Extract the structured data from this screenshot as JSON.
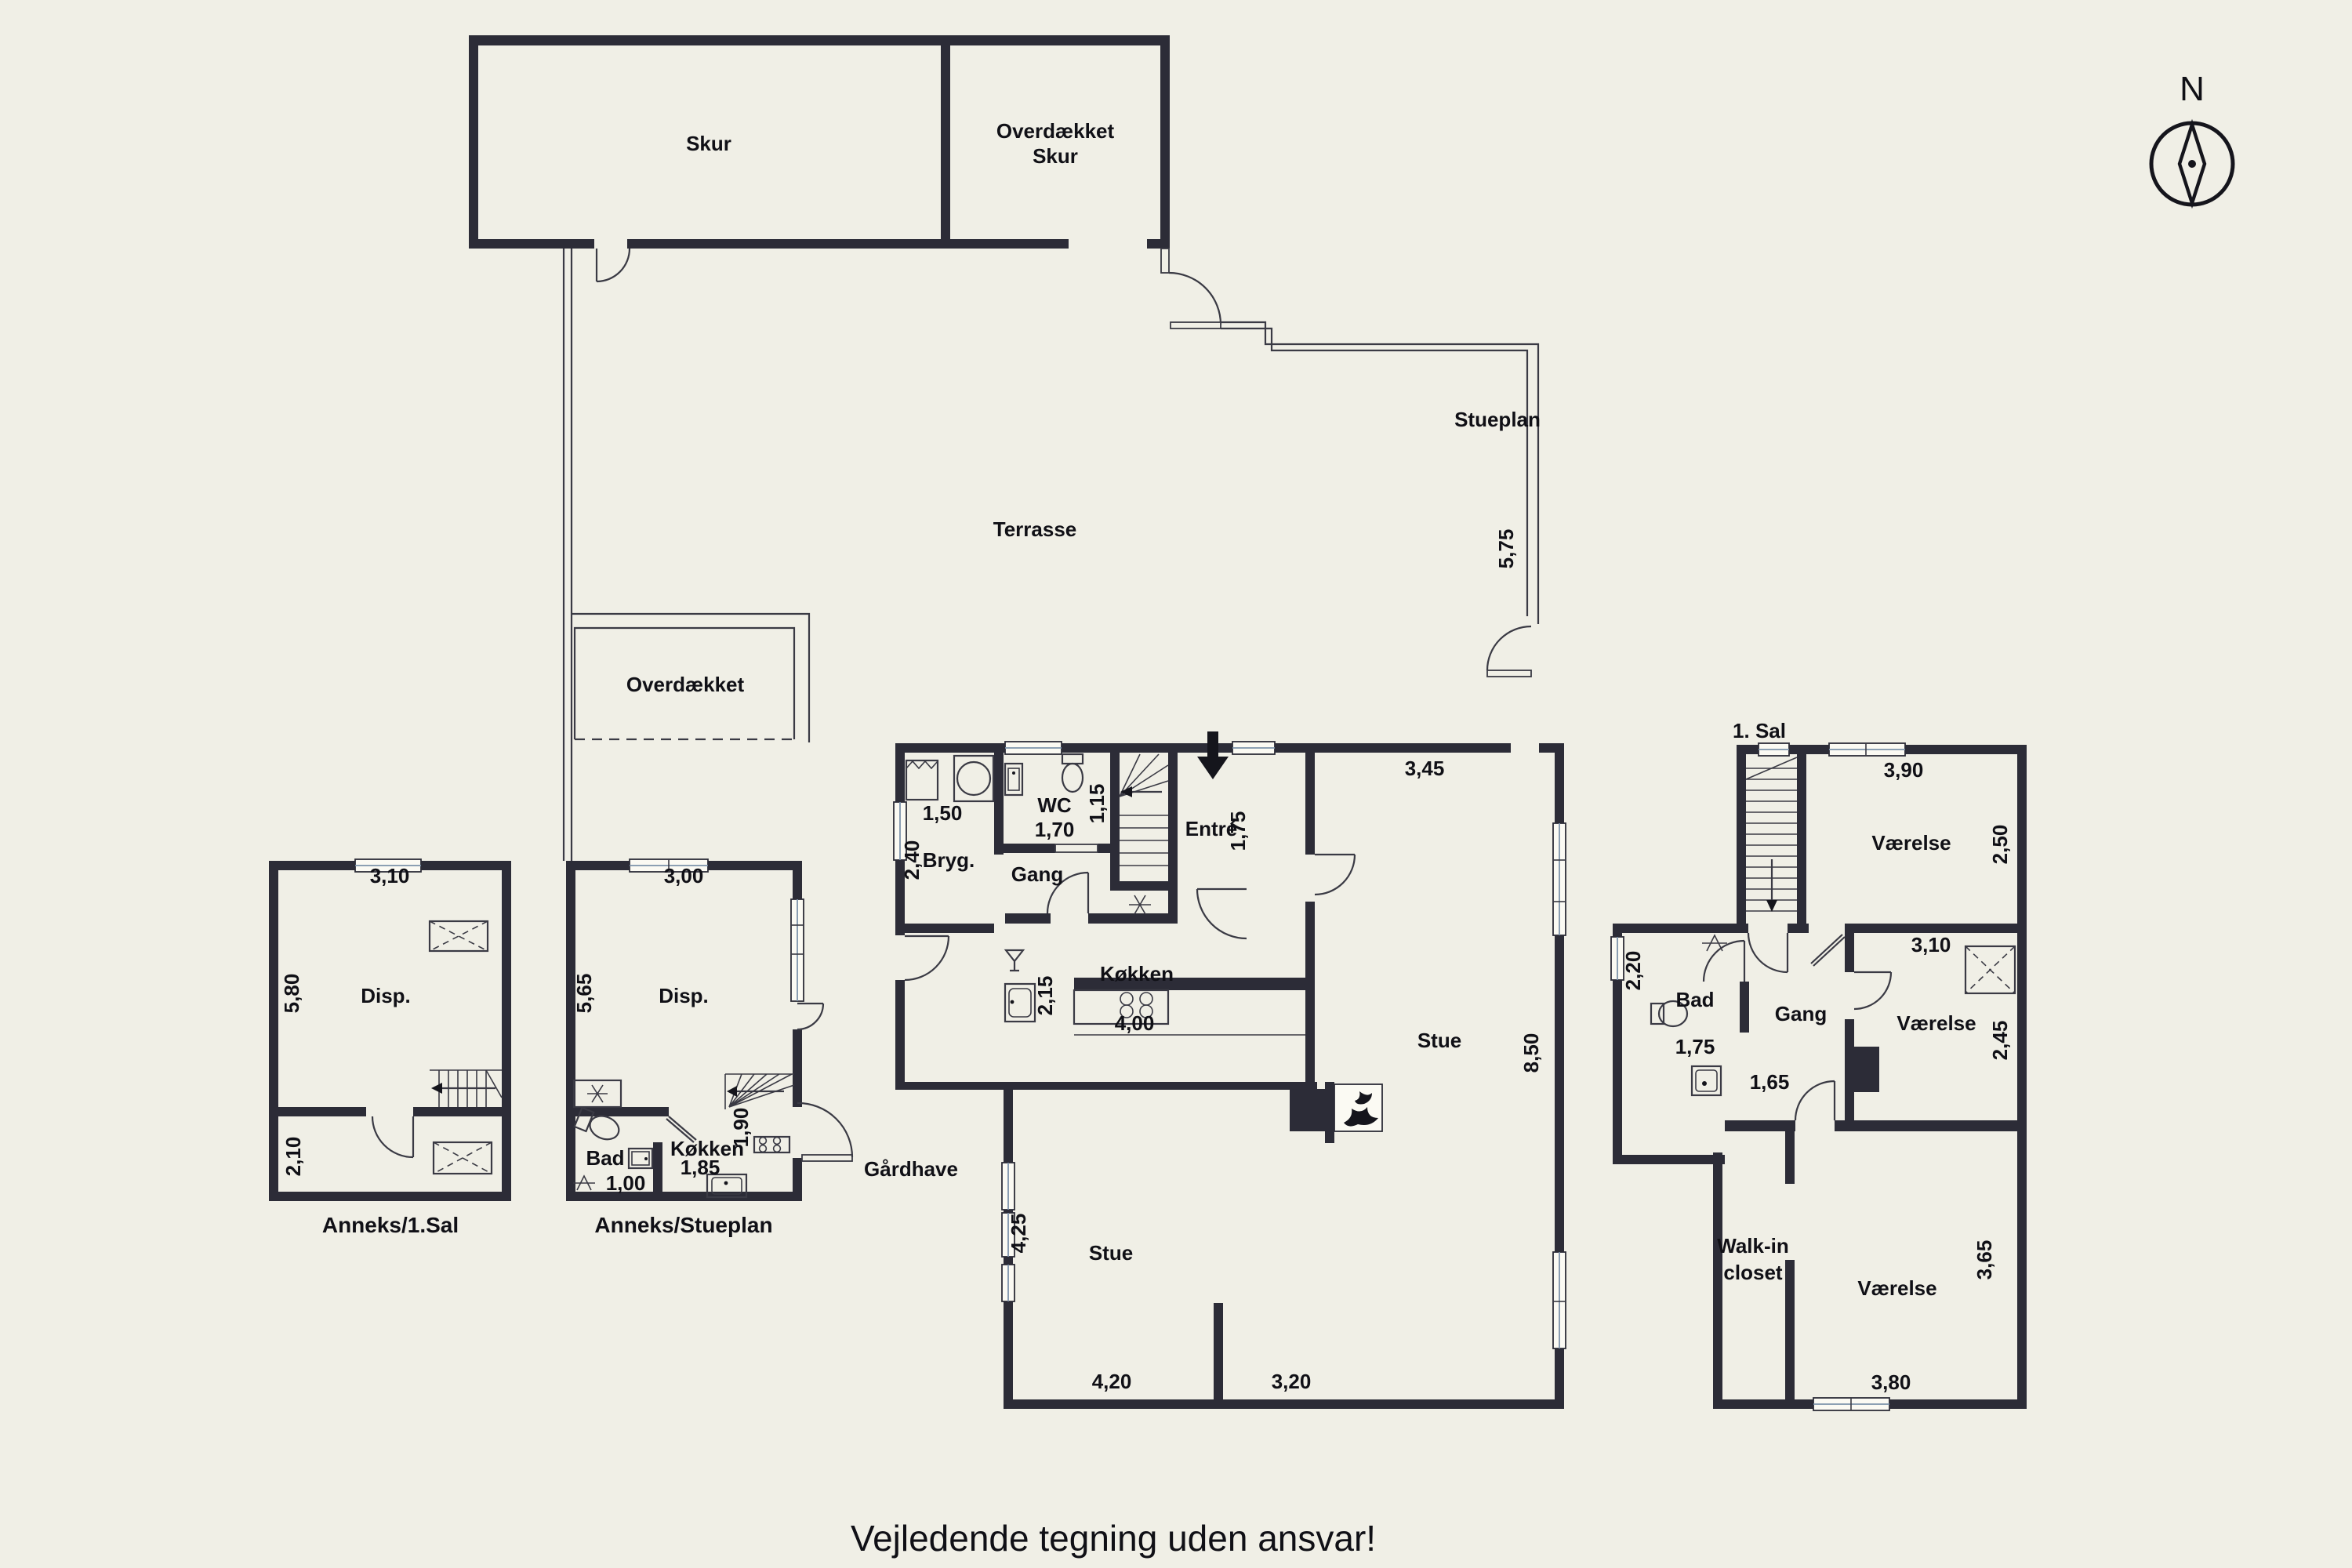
{
  "colors": {
    "background": "#f0efe6",
    "wall": "#2c2c37",
    "thin_line": "#3a3a44",
    "text": "#101016",
    "window_glass": "#7d93aa"
  },
  "labels": {
    "skur": "Skur",
    "ods1": "Overdækket",
    "ods2": "Skur",
    "terrasse": "Terrasse",
    "overdaekket": "Overdækket",
    "stueplan": "Stueplan",
    "d575": "5,75",
    "bryg": "Bryg.",
    "d150": "1,50",
    "d240": "2,40",
    "wc": "WC",
    "d170": "1,70",
    "d115": "1,15",
    "gang": "Gang",
    "entre": "Entré",
    "d175": "1,75",
    "d345": "3,45",
    "koekken": "Køkken",
    "d215": "2,15",
    "d400": "4,00",
    "stue": "Stue",
    "d850": "8,50",
    "d425": "4,25",
    "stue2": "Stue",
    "d420": "4,20",
    "d320": "3,20",
    "sal": "1. Sal",
    "d390": "3,90",
    "vaerelse_n": "Værelse",
    "d250": "2,50",
    "d220": "2,20",
    "bad": "Bad",
    "d175b": "1,75",
    "gang2": "Gang",
    "d165": "1,65",
    "d310": "3,10",
    "vaerelse_s": "Værelse",
    "d245": "2,45",
    "walkin1": "Walk-in",
    "walkin2": "closet",
    "vaerelse_se": "Værelse",
    "d380": "3,80",
    "d365": "3,65",
    "d310b": "3,10",
    "d580": "5,80",
    "disp": "Disp.",
    "d210": "2,10",
    "anneks1": "Anneks/1.Sal",
    "d300": "3,00",
    "d565": "5,65",
    "disp2": "Disp.",
    "bad2": "Bad",
    "d100": "1,00",
    "koekken2": "Køkken",
    "d185": "1,85",
    "d190": "1,90",
    "anneks0": "Anneks/Stueplan",
    "gaardhave": "Gårdhave",
    "north": "N",
    "footer": "Vejledende tegning uden ansvar!"
  }
}
